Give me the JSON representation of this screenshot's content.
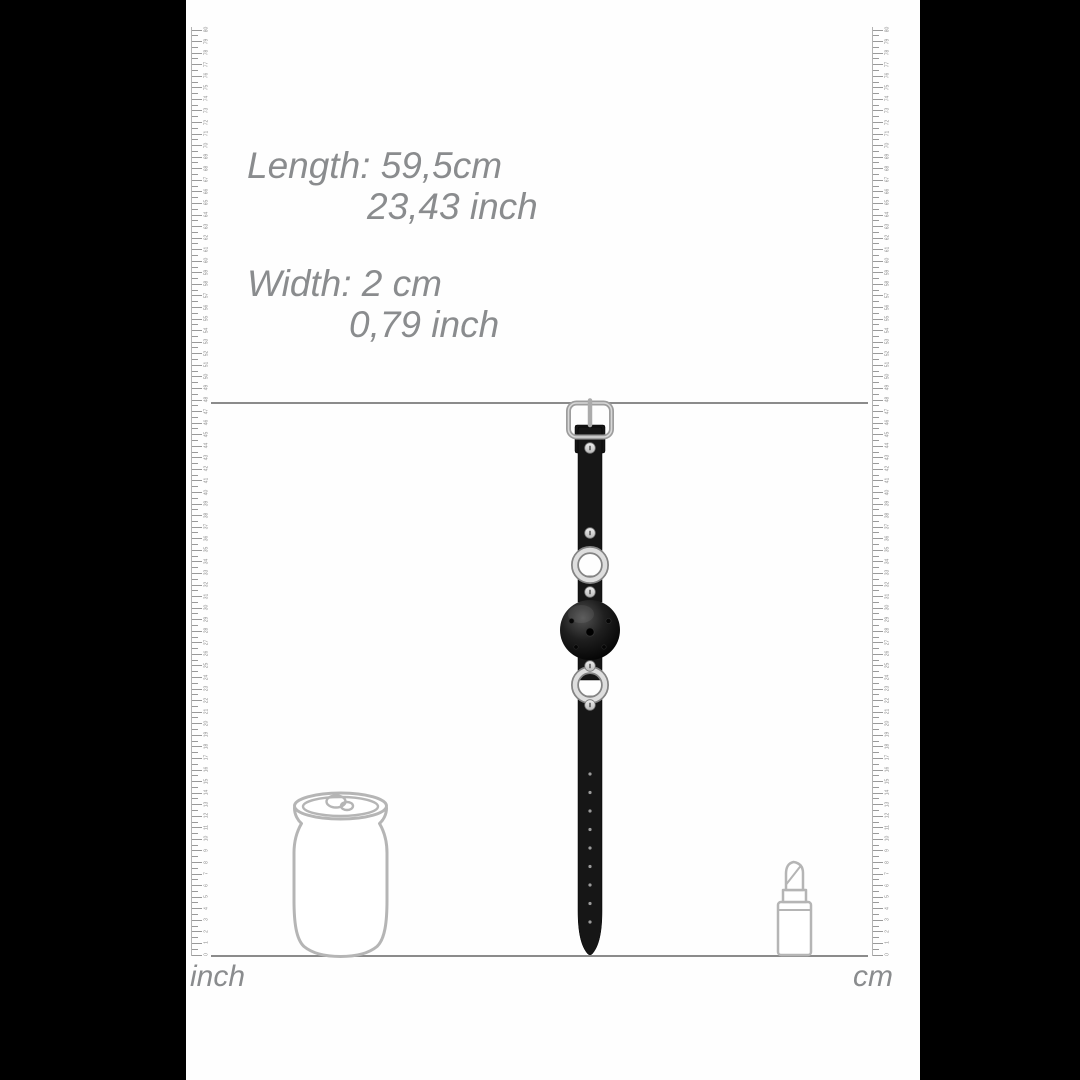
{
  "colors": {
    "side_bar": "#000000",
    "content_bg": "#fefefe",
    "dim_text": "#8a8c8e",
    "guide_line": "#8b8b8b",
    "ruler_tick": "#9a9a9a",
    "ruler_number": "#8c8c8c",
    "ruler_edge": "#b3b3b3",
    "reference_outline": "#b5b5b5",
    "strap": "#161616"
  },
  "dimension_text": {
    "length_line1": "Length: 59,5cm",
    "length_line2": "23,43 inch",
    "width_line1": "Width: 2 cm",
    "width_line2": "0,79 inch"
  },
  "rulers": {
    "left": {
      "label": "inch",
      "numbers_from": 0,
      "numbers_to": 80
    },
    "right": {
      "label": "cm",
      "numbers_from": 0,
      "numbers_to": 80
    }
  },
  "product": {
    "name": "ball-gag-with-adjustable-strap",
    "adjustment_hole_count": 9,
    "hole_start_y": 379,
    "hole_step_y": 18.5
  },
  "reference_objects": {
    "left": "drink-can",
    "right": "lipstick"
  }
}
